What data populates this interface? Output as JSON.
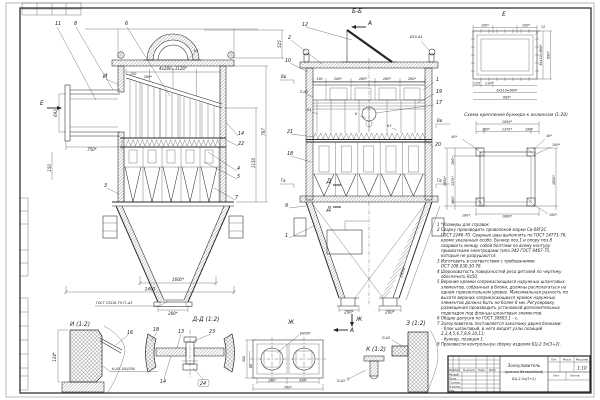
{
  "views": {
    "left": {
      "callouts": {
        "p11": "11",
        "p8": "8",
        "p6": "6",
        "p3": "3",
        "p14": "14",
        "p22": "22",
        "p4": "4",
        "p5": "5",
        "p7": "7"
      },
      "marks": {
        "detail_i": "И",
        "view_e": "Е",
        "weld_k2": "К2",
        "weld_gost": "ГОСТ 23518-79-Т1-Δ3"
      },
      "dims": {
        "top_pitch": "4х280=1120*",
        "inlet_height": "692",
        "inlet_width": "750*",
        "d150": "150",
        "d280": "280*",
        "h525": "525",
        "h787": "787",
        "h1150": "1150",
        "side150": "150",
        "hopper": "1600*",
        "overall": "2400",
        "outlet": "200*"
      }
    },
    "bb": {
      "title": "Б-Б",
      "cut_top": "А",
      "cut_bottom": "А",
      "view_zh": "Ж",
      "cut_d": "Д",
      "callouts": {
        "p12": "12",
        "p2": "2",
        "p10": "10",
        "p1": "1",
        "p19": "19",
        "p17": "17",
        "p21": "21",
        "p20": "20",
        "p18": "18",
        "p9": "9",
        "p1b": "1"
      },
      "levels": {
        "bv_l": "Вв",
        "gv_l": "Гв",
        "bv_r": "Вв",
        "gv_r": "Гв"
      },
      "dims": {
        "d150": "150",
        "d280": "280*",
        "slope": "1650*",
        "out": "200*",
        "hole": "Ø18-Δ4"
      },
      "welds": {
        "p": "П-Δ3",
        "k1": "К1",
        "k": "К",
        "k3": "К3"
      }
    },
    "e": {
      "title": "Е",
      "dims": {
        "d100": "100*",
        "d12": "12",
        "v660": "6х110=660*",
        "v690": "690*",
        "d125": "125",
        "d110": "110*",
        "b660": "6х110=660*",
        "b690": "690*"
      }
    },
    "scheme": {
      "caption": "Схема крепления бункера к колоннам (1:20)",
      "dims": {
        "o1850": "1850*",
        "s180": "180*",
        "s1370": "1370*",
        "d40": "40*",
        "d100": "100*",
        "b1600": "1600*",
        "b180": "180*"
      }
    }
  },
  "details": {
    "i": {
      "title": "И (1:2)",
      "weld": "Н-Δ3-100/200",
      "dim124": "124*",
      "c16": "16"
    },
    "dd": {
      "title": "Д-Д (1:2)",
      "c18": "18",
      "c13": "13",
      "c23": "23",
      "c14": "14",
      "c24": "24"
    },
    "zh": {
      "title": "Ж",
      "dia": "Ø450*",
      "d300": "300",
      "d80": "80",
      "d180": "180*",
      "d450": "450*",
      "d760": "760*"
    },
    "k": {
      "title": "К (1:2)",
      "weld": "П-Δ3"
    },
    "z": {
      "title": "З (1:2)",
      "weld": "П-Δ3"
    }
  },
  "notes": {
    "lines": [
      "1 *Размеры для справок.",
      "2 Сварку производить проволокой марки Св-08Г2С",
      "ГОСТ 2246-70. Сварные швы выполнять по ГОСТ 14771-76,",
      "кроме указанных особо. Бункер поз.1 и опору поз.8",
      "сваривать между собой болтами по всему контуру",
      "прихватками электродами типа Э42 ГОСТ 9467-75,",
      "которые не разрушаются.",
      "3 Изготовить в соответствии с требованиями",
      "ОСТ 108.030.30-78.",
      "4 Шероховатость поверхностей реза деталей по чертежу",
      "обеспечить Rz50.",
      "5 Верхние кромки соприкасающихся наружных шланговых",
      "элементов, собранных в блоки, должны располагаться на",
      "одном горизонтальном уровне. Максимальная разность по",
      "высоте верхних соприкасающихся кромок наружных",
      "элементов должна быть не более 8 мм. Регулировку",
      "размещения производить установкой дополнительных",
      "подкладок под фланцы шланговых элементов.",
      "6 Общие допуски по ГОСТ 30893.1 - с.",
      "7 Золоуловитель поставляется заказчику двумя блоками:",
      "- блок шланговый, в него входят узлы позиций",
      "2,3,4,5,6,7,8,9,10,11;",
      "- бункер, позиция 1.",
      "8 Произвести контрольную сборку изделия БЦ-2-5х(3+2)."
    ]
  },
  "title_block": {
    "doc_name_1": "Золоуловитель",
    "doc_name_2": "(циклон батарейный)",
    "doc_name_3": "БЦ-2-5х(3+2)",
    "scale": "1:10",
    "cols": {
      "izm": "Изм.",
      "list": "Лист",
      "doc": "№ докум.",
      "podp": "Подп.",
      "data": "Дата"
    },
    "rows": {
      "razrab": "Разраб.",
      "prov": "Пров.",
      "tkontr": "Т.контр.",
      "nkontr": "Н.контр.",
      "utv": "Утв."
    },
    "right": {
      "lit": "Лит.",
      "massa": "Масса",
      "masshtab": "Масштаб",
      "list": "Лист",
      "listov": "Листов"
    }
  }
}
